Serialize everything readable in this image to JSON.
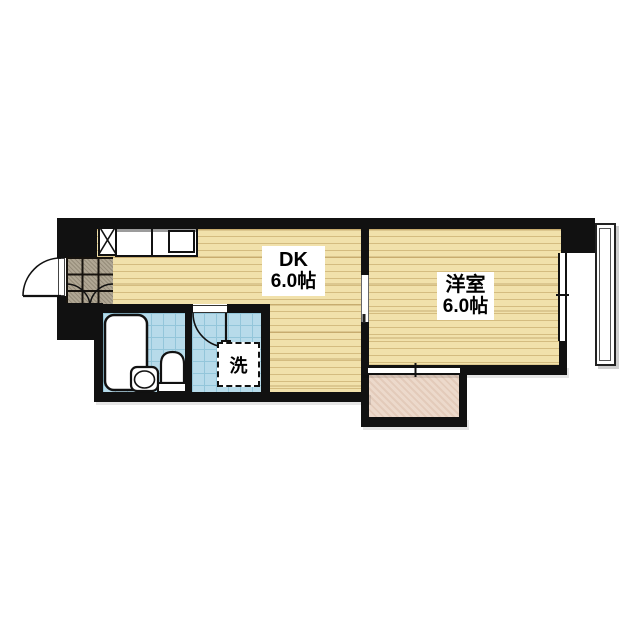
{
  "floor_plan": {
    "title": "1DK apartment floor plan",
    "rooms": {
      "dk": {
        "name": "DK",
        "size": "6.0帖"
      },
      "western_room": {
        "name": "洋室",
        "size": "6.0帖"
      },
      "laundry": {
        "label": "洗"
      }
    },
    "colors": {
      "background": "#ffffff",
      "wall": "#111111",
      "wood_floor": "#f1e1ab",
      "genkan_tile": "#b0a794",
      "tile_blue": "#b7dbea",
      "tile_blue_line": "#93c6da",
      "balcony_pink": "#ecd9cb"
    }
  }
}
